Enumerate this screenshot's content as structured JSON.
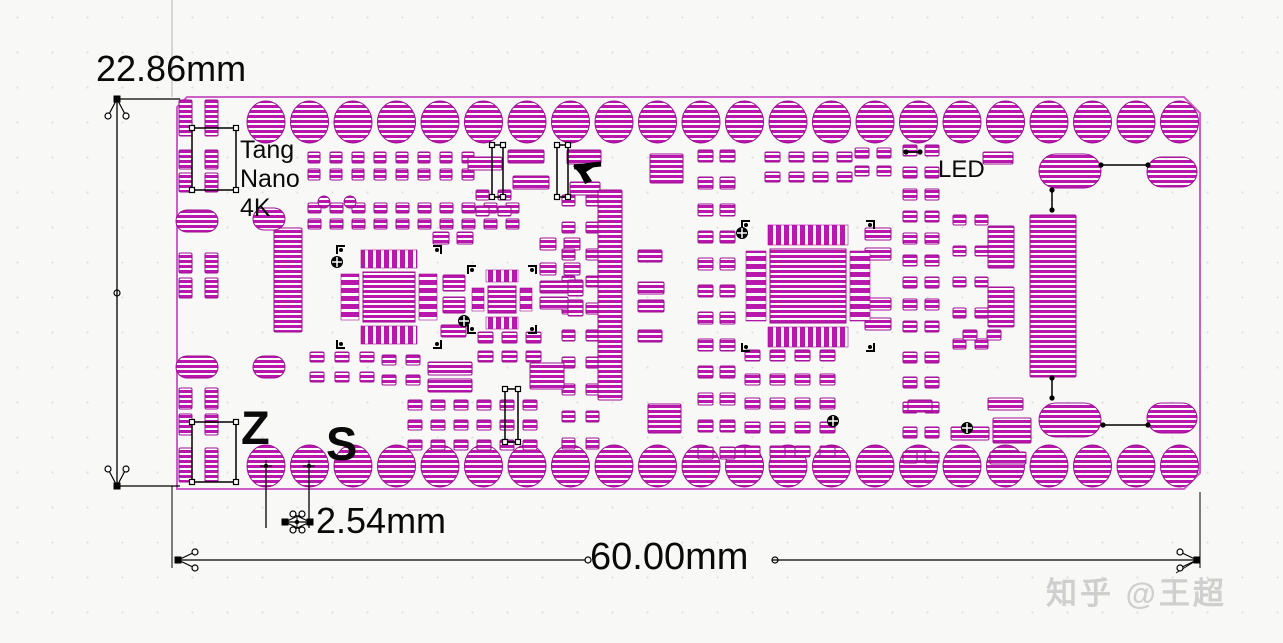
{
  "page": {
    "background": "#f8f8f6"
  },
  "labels": {
    "height_dim": "22.86mm",
    "pitch_dim": "2.54mm",
    "width_dim": "60.00mm",
    "board_name_line1": "Tang",
    "board_name_line2": "Nano",
    "board_name_line3": "4K",
    "led": "LED",
    "silk_z": "Z",
    "silk_s": "S",
    "watermark": "知乎 @王超"
  },
  "colors": {
    "pad": "#b818ab",
    "pad_stroke": "#9c0f93",
    "board_edge": "#cc5fc6",
    "annotation": "#000000",
    "extension_gray": "#b5b5b5",
    "watermark": "#cfcfcf"
  },
  "board": {
    "x": 177,
    "y": 97,
    "w": 1023,
    "h": 392,
    "chamfer": 16
  },
  "layout": {
    "circleRows": [
      {
        "x0": 266,
        "y": 122,
        "dx": 43.5,
        "n": 22,
        "r": 20
      },
      {
        "x0": 266,
        "y": 466,
        "dx": 43.5,
        "n": 22,
        "r": 20
      }
    ],
    "padGrids": [
      {
        "x": 179,
        "y": 100,
        "dx": 26,
        "dy": 0,
        "nx": 2,
        "ny": 1,
        "w": 13,
        "h": 36
      },
      {
        "x": 179,
        "y": 150,
        "dx": 26,
        "dy": 23,
        "nx": 2,
        "ny": 2,
        "w": 13,
        "h": 19
      },
      {
        "x": 179,
        "y": 253,
        "dx": 26,
        "dy": 25,
        "nx": 2,
        "ny": 2,
        "w": 13,
        "h": 20
      },
      {
        "x": 179,
        "y": 388,
        "dx": 26,
        "dy": 26,
        "nx": 2,
        "ny": 2,
        "w": 13,
        "h": 21
      },
      {
        "x": 179,
        "y": 448,
        "dx": 26,
        "dy": 0,
        "nx": 2,
        "ny": 1,
        "w": 13,
        "h": 34
      },
      {
        "x": 308,
        "y": 152,
        "dx": 22,
        "dy": 17,
        "nx": 8,
        "ny": 2,
        "w": 12,
        "h": 11
      },
      {
        "x": 308,
        "y": 203,
        "dx": 22,
        "dy": 16,
        "nx": 10,
        "ny": 2,
        "w": 13,
        "h": 10
      },
      {
        "x": 698,
        "y": 150,
        "dx": 22,
        "dy": 27,
        "nx": 2,
        "ny": 12,
        "w": 15,
        "h": 12
      },
      {
        "x": 903,
        "y": 145,
        "dx": 22,
        "dy": 22,
        "nx": 2,
        "ny": 9,
        "w": 14,
        "h": 11
      },
      {
        "x": 903,
        "y": 352,
        "dx": 22,
        "dy": 25,
        "nx": 2,
        "ny": 5,
        "w": 14,
        "h": 11
      },
      {
        "x": 953,
        "y": 215,
        "dx": 22,
        "dy": 31,
        "nx": 2,
        "ny": 5,
        "w": 13,
        "h": 10
      },
      {
        "x": 765,
        "y": 152,
        "dx": 24,
        "dy": 20,
        "nx": 4,
        "ny": 2,
        "w": 15,
        "h": 10
      },
      {
        "x": 855,
        "y": 148,
        "dx": 22,
        "dy": 18,
        "nx": 2,
        "ny": 2,
        "w": 14,
        "h": 10
      },
      {
        "x": 433,
        "y": 232,
        "dx": 24,
        "dy": 0,
        "nx": 2,
        "ny": 1,
        "w": 16,
        "h": 12
      },
      {
        "x": 540,
        "y": 238,
        "dx": 24,
        "dy": 25,
        "nx": 2,
        "ny": 2,
        "w": 16,
        "h": 12
      },
      {
        "x": 310,
        "y": 352,
        "dx": 25,
        "dy": 20,
        "nx": 3,
        "ny": 2,
        "w": 14,
        "h": 10
      },
      {
        "x": 382,
        "y": 355,
        "dx": 24,
        "dy": 20,
        "nx": 2,
        "ny": 2,
        "w": 14,
        "h": 10
      },
      {
        "x": 408,
        "y": 400,
        "dx": 23,
        "dy": 20,
        "nx": 6,
        "ny": 3,
        "w": 14,
        "h": 10
      },
      {
        "x": 745,
        "y": 350,
        "dx": 25,
        "dy": 24,
        "nx": 4,
        "ny": 5,
        "w": 15,
        "h": 11
      },
      {
        "x": 963,
        "y": 330,
        "dx": 24,
        "dy": 0,
        "nx": 2,
        "ny": 1,
        "w": 14,
        "h": 10
      },
      {
        "x": 476,
        "y": 190,
        "dx": 22,
        "dy": 16,
        "nx": 2,
        "ny": 2,
        "w": 13,
        "h": 10
      },
      {
        "x": 478,
        "y": 332,
        "dx": 24,
        "dy": 19,
        "nx": 3,
        "ny": 2,
        "w": 15,
        "h": 11
      },
      {
        "x": 562,
        "y": 195,
        "dx": 24,
        "dy": 27,
        "nx": 2,
        "ny": 10,
        "w": 13,
        "h": 11
      }
    ],
    "rects": [
      [
        468,
        157,
        34,
        13
      ],
      [
        508,
        150,
        36,
        13
      ],
      [
        513,
        176,
        36,
        13
      ],
      [
        567,
        150,
        34,
        14
      ],
      [
        570,
        182,
        30,
        13
      ],
      [
        650,
        154,
        33,
        29
      ],
      [
        648,
        404,
        33,
        29
      ],
      [
        598,
        190,
        24,
        210
      ],
      [
        1030,
        215,
        46,
        162
      ],
      [
        274,
        228,
        28,
        104
      ],
      [
        443,
        275,
        22,
        16
      ],
      [
        443,
        297,
        22,
        16
      ],
      [
        441,
        325,
        25,
        12
      ],
      [
        540,
        281,
        28,
        12
      ],
      [
        540,
        297,
        28,
        12
      ],
      [
        568,
        280,
        15,
        16
      ],
      [
        568,
        300,
        15,
        16
      ],
      [
        638,
        250,
        24,
        12
      ],
      [
        638,
        282,
        26,
        12
      ],
      [
        638,
        300,
        26,
        12
      ],
      [
        638,
        330,
        24,
        12
      ],
      [
        428,
        362,
        44,
        13
      ],
      [
        428,
        379,
        44,
        13
      ],
      [
        530,
        363,
        34,
        26
      ],
      [
        983,
        152,
        30,
        12
      ],
      [
        988,
        226,
        26,
        42
      ],
      [
        988,
        287,
        26,
        40
      ],
      [
        988,
        398,
        35,
        12
      ],
      [
        993,
        418,
        38,
        25
      ],
      [
        990,
        452,
        36,
        12
      ],
      [
        908,
        400,
        24,
        12
      ],
      [
        951,
        427,
        38,
        13
      ],
      [
        865,
        228,
        26,
        12
      ],
      [
        865,
        248,
        26,
        12
      ],
      [
        865,
        298,
        26,
        12
      ],
      [
        865,
        318,
        26,
        12
      ]
    ],
    "ovals": [
      [
        197,
        221,
        21,
        11
      ],
      [
        269,
        219,
        16,
        11
      ],
      [
        197,
        367,
        21,
        11
      ],
      [
        269,
        367,
        16,
        11
      ],
      [
        1070,
        171,
        31,
        17
      ],
      [
        1172,
        172,
        25,
        15
      ],
      [
        1070,
        420,
        31,
        17
      ],
      [
        1172,
        418,
        25,
        15
      ]
    ],
    "smallCircles": [
      [
        324,
        202,
        6
      ],
      [
        350,
        202,
        6
      ]
    ],
    "qfps": [
      {
        "x": 363,
        "y": 272,
        "w": 52,
        "h": 50,
        "comb": 18
      },
      {
        "x": 488,
        "y": 286,
        "w": 28,
        "h": 27,
        "comb": 12
      },
      {
        "x": 770,
        "y": 249,
        "w": 76,
        "h": 74,
        "comb": 20
      }
    ],
    "fiducials": [
      [
        337,
        262
      ],
      [
        464,
        321
      ],
      [
        742,
        233
      ],
      [
        833,
        421
      ],
      [
        967,
        428
      ]
    ],
    "courtyards": [
      [
        192,
        128,
        44,
        62
      ],
      [
        192,
        422,
        44,
        60
      ],
      [
        492,
        145,
        11,
        52
      ],
      [
        557,
        145,
        11,
        52
      ],
      [
        505,
        389,
        13,
        53
      ]
    ],
    "links": [
      [
        1101,
        165,
        1148,
        165
      ],
      [
        1052,
        190,
        1052,
        210
      ],
      [
        1103,
        425,
        1148,
        425
      ],
      [
        1052,
        378,
        1052,
        398
      ],
      [
        906,
        152,
        920,
        152
      ]
    ],
    "cursor": [
      [
        573,
        166
      ],
      [
        600,
        163
      ],
      [
        586,
        172
      ],
      [
        592,
        181
      ],
      [
        585,
        184
      ],
      [
        580,
        174
      ],
      [
        573,
        166
      ]
    ]
  },
  "dims": {
    "lines": [
      [
        117,
        100,
        117,
        485
      ],
      [
        117,
        99,
        180,
        99
      ],
      [
        117,
        486,
        180,
        486
      ],
      [
        178,
        560,
        585,
        560
      ],
      [
        772,
        560,
        1197,
        560
      ],
      [
        266,
        468,
        266,
        528
      ],
      [
        309,
        468,
        309,
        528
      ],
      [
        283,
        522,
        312,
        522
      ]
    ],
    "gray_lines": [
      [
        172,
        0,
        172,
        97
      ]
    ],
    "thin_black": [
      [
        172,
        486,
        172,
        568
      ],
      [
        1200,
        492,
        1200,
        568
      ],
      [
        1197,
        560,
        1176,
        573
      ]
    ],
    "open_dots": [
      [
        117,
        293
      ],
      [
        588,
        560
      ],
      [
        775,
        560
      ]
    ],
    "cross_dots": [
      [
        266,
        466
      ],
      [
        309,
        466
      ],
      [
        297,
        522
      ]
    ],
    "crowfeet": [
      [
        117,
        99,
        "down"
      ],
      [
        117,
        486,
        "up"
      ],
      [
        178,
        560,
        "right"
      ],
      [
        1197,
        560,
        "left"
      ],
      [
        285,
        522,
        "right"
      ],
      [
        310,
        522,
        "left"
      ]
    ]
  }
}
